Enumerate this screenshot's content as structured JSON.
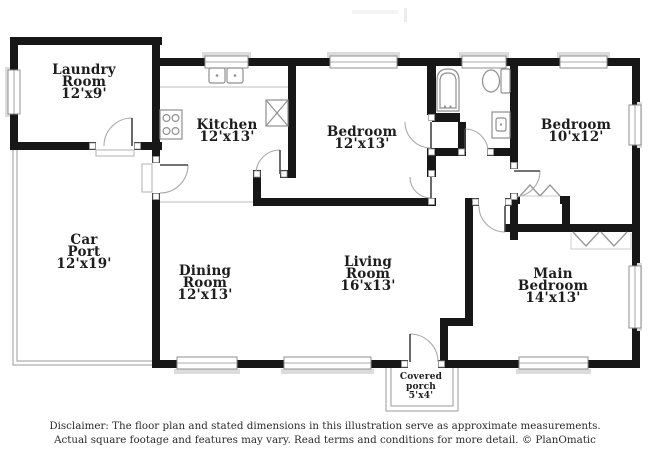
{
  "rooms": [
    {
      "id": "laundry_room",
      "lines": [
        "Laundry",
        "Room",
        "12'x9'"
      ]
    },
    {
      "id": "kitchen",
      "lines": [
        "Kitchen",
        "12'x13'"
      ]
    },
    {
      "id": "bedroom_1",
      "lines": [
        "Bedroom",
        "12'x13'"
      ]
    },
    {
      "id": "bedroom_2",
      "lines": [
        "Bedroom",
        "10'x12'"
      ]
    },
    {
      "id": "car_port",
      "lines": [
        "Car",
        "Port",
        "12'x19'"
      ]
    },
    {
      "id": "dining_room",
      "lines": [
        "Dining",
        "Room",
        "12'x13'"
      ]
    },
    {
      "id": "living_room",
      "lines": [
        "Living",
        "Room",
        "16'x13'"
      ]
    },
    {
      "id": "main_bedroom",
      "lines": [
        "Main",
        "Bedroom",
        "14'x13'"
      ]
    },
    {
      "id": "covered_porch",
      "lines": [
        "Covered",
        "porch",
        "5'x4'"
      ]
    }
  ],
  "footer": {
    "line1": "Disclaimer: The floor plan and stated dimensions in this illustration serve as approximate measurements.",
    "line2": "Actual square footage and features may vary. Read terms and conditions for more detail. © PlanOmatic"
  },
  "fixtures": [
    "bathtub",
    "toilet",
    "vanity-sink",
    "kitchen-sink",
    "stove-burners",
    "water-heater",
    "door-swing",
    "bifold-closet-doors",
    "window"
  ],
  "colors": {
    "wall": "#171717",
    "fixture_line": "#8f8f8f",
    "window_sill": "#dcdcdc",
    "text": "#1d1d1d"
  }
}
